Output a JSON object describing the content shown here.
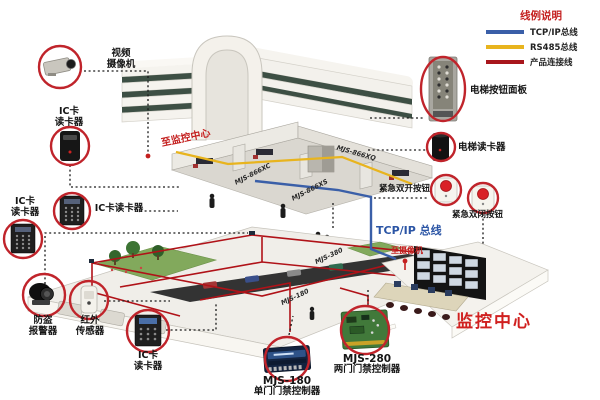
{
  "legend": {
    "title": "线例说明",
    "items": [
      {
        "label": "TCP/IP总线",
        "color": "#3a5fa8"
      },
      {
        "label": "RS485总线",
        "color": "#e8b41e"
      },
      {
        "label": "产品连接线",
        "color": "#a8161c"
      }
    ]
  },
  "labels": {
    "camera": "视频\n摄像机",
    "ic_reader_1": "IC卡\n读卡器",
    "ic_reader_2": "IC卡\n读卡器",
    "ic_reader_2b": "IC卡读卡器",
    "alarm": "防盗\n报警器",
    "ir_sensor": "红外\n传感器",
    "ic_reader_3": "IC卡\n读卡器",
    "elevator_panel": "电梯按钮面板",
    "elevator_reader": "电梯读卡器",
    "emergency_open": "紧急双开按钮",
    "emergency_close": "紧急双闭按钮"
  },
  "controllers": {
    "mjs180": {
      "name": "MJS-180",
      "desc": "单门门禁控制器"
    },
    "mjs280": {
      "name": "MJS-280",
      "desc": "两门门禁控制器"
    }
  },
  "annotations": {
    "to_monitor_center": "至监控中心",
    "to_camera": "至摄像机",
    "tcpip_bus": "TCP/IP 总线",
    "monitor_center": "监控中心"
  },
  "floor_labels": {
    "f1": "MJS-866XQ",
    "f2": "MJS-866XC",
    "f3": "MJS-866XS",
    "b1": "MJS-380",
    "b2": "MJS-180"
  },
  "colors": {
    "circle_red": "#c0242b",
    "tcpip_blue": "#3a5fa8",
    "rs485_yellow": "#e8b41e",
    "product_red": "#a8161c"
  }
}
